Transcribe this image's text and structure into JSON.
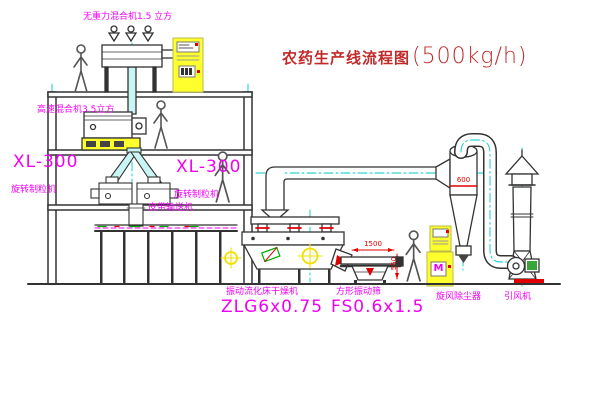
{
  "title": {
    "name": "农药生产线流程图",
    "capacity": "(500kg/h)"
  },
  "equipment": {
    "gravity_free_mixer": {
      "label": "无重力混合机1.5 立方"
    },
    "high_speed_mixer": {
      "label": "高速混合机3.5立方"
    },
    "granulator_left": {
      "model": "XL-300",
      "name": "旋转制粒机"
    },
    "granulator_right": {
      "model": "XL-300",
      "name": "旋转制粒机"
    },
    "belt_conveyor": {
      "name": "皮带输送机"
    },
    "fluid_bed_dryer": {
      "name": "振动流化床干燥机",
      "model": "ZLG6x0.75"
    },
    "square_sieve": {
      "name": "方形振动筛",
      "model": "FS0.6x1.5"
    },
    "cyclone": {
      "name": "旋风除尘器"
    },
    "fan": {
      "name": "引风机"
    }
  },
  "dimensions": {
    "sieve_width": "1500",
    "sieve_height": "550",
    "cyclone_body": "600"
  },
  "icons": {
    "motor_symbol": "M"
  },
  "colors": {
    "label_magenta": "#f200f2",
    "title_red": "#c22a2a",
    "dimension_red": "#e00000",
    "centerline_cyan": "#00c8c8",
    "cabinet_yellow": "#ffff2e",
    "line_dark": "#333333"
  }
}
